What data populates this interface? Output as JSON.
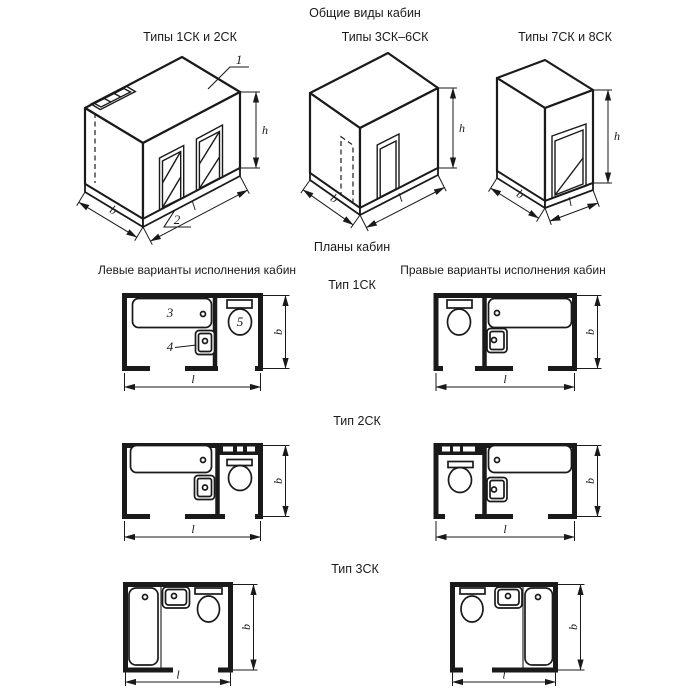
{
  "page": {
    "title": "Общие виды кабин",
    "plans_title": "Планы кабин",
    "left_variants_header": "Левые варианты исполнения кабин",
    "right_variants_header": "Правые варианты исполнения кабин"
  },
  "general_views": [
    {
      "label": "Типы 1СК и 2СК"
    },
    {
      "label": "Типы 3СК–6СК"
    },
    {
      "label": "Типы 7СК и 8СК"
    }
  ],
  "plan_rows": [
    {
      "label": "Тип 1СК"
    },
    {
      "label": "Тип 2СК"
    },
    {
      "label": "Тип 3СК"
    }
  ],
  "dimensions": {
    "width": "b",
    "length": "l",
    "height": "h"
  },
  "callouts": {
    "ceiling_panel": "1",
    "floor_panel": "2",
    "bathtub": "3",
    "washbasin": "4",
    "toilet": "5"
  },
  "colors": {
    "line": "#1a1a1a",
    "background": "#ffffff"
  }
}
